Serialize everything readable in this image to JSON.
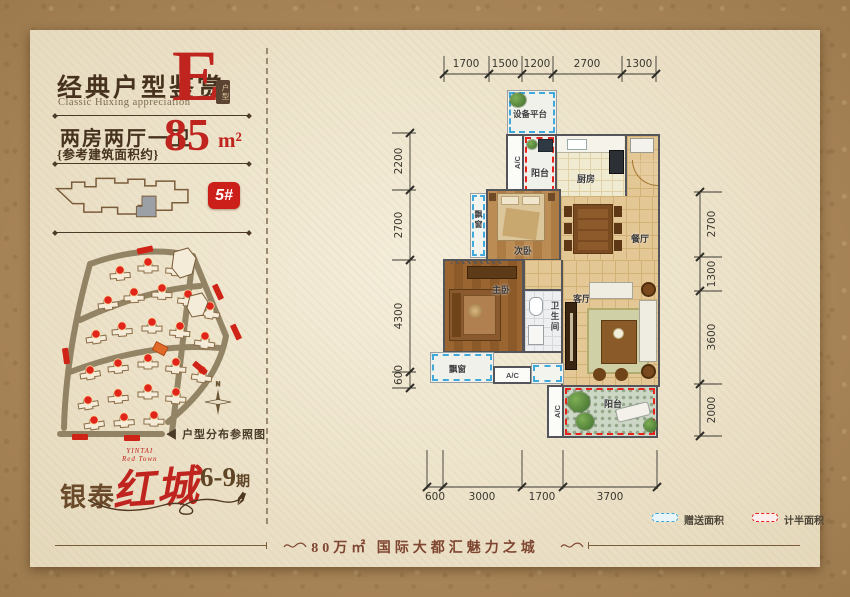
{
  "colors": {
    "accent_red": "#c0241e",
    "dash_blue": "#3fa9dc",
    "dash_red": "#e8231e",
    "wall": "#54555a",
    "ink": "#46321f"
  },
  "header": {
    "title": "经典户型鉴赏",
    "subtitle": "Classic Huxing appreciation",
    "unit_letter": "E",
    "unit_seal": "户型",
    "spec": "两房两厅一卫",
    "spec_note": "{参考建筑面积约}",
    "area_value": "85",
    "area_unit": "m²",
    "building_badge": "5#"
  },
  "siteplan": {
    "caption_arrow": "◀",
    "caption": "户型分布参照图",
    "compass": "N"
  },
  "logo": {
    "brand": "银泰",
    "name": "红城",
    "phase_num": "6-9",
    "phase_suffix": "期",
    "en_top": "YINTAI",
    "en_bottom": "Red Town",
    "pen": "✒"
  },
  "plan": {
    "rooms": {
      "equipment": "设备平台",
      "balcony": "阳台",
      "kitchen": "厨房",
      "bay": "飘窗",
      "bedroom2": "次卧",
      "dining": "餐厅",
      "bedroom1": "主卧",
      "living": "客厅",
      "bath": "卫生间",
      "ac": "A/C"
    },
    "dims": {
      "top": [
        "1700",
        "1500",
        "1200",
        "2700",
        "1300"
      ],
      "left": [
        "2200",
        "2700",
        "4300",
        "600"
      ],
      "right": [
        "2700",
        "1300",
        "3600",
        "2000"
      ],
      "bottom": [
        "600",
        "3000",
        "1700",
        "3700"
      ]
    }
  },
  "legend": {
    "gift": "赠送面积",
    "half": "计半面积"
  },
  "footer": {
    "tagline": "80万㎡ 国际大都汇魅力之城"
  }
}
